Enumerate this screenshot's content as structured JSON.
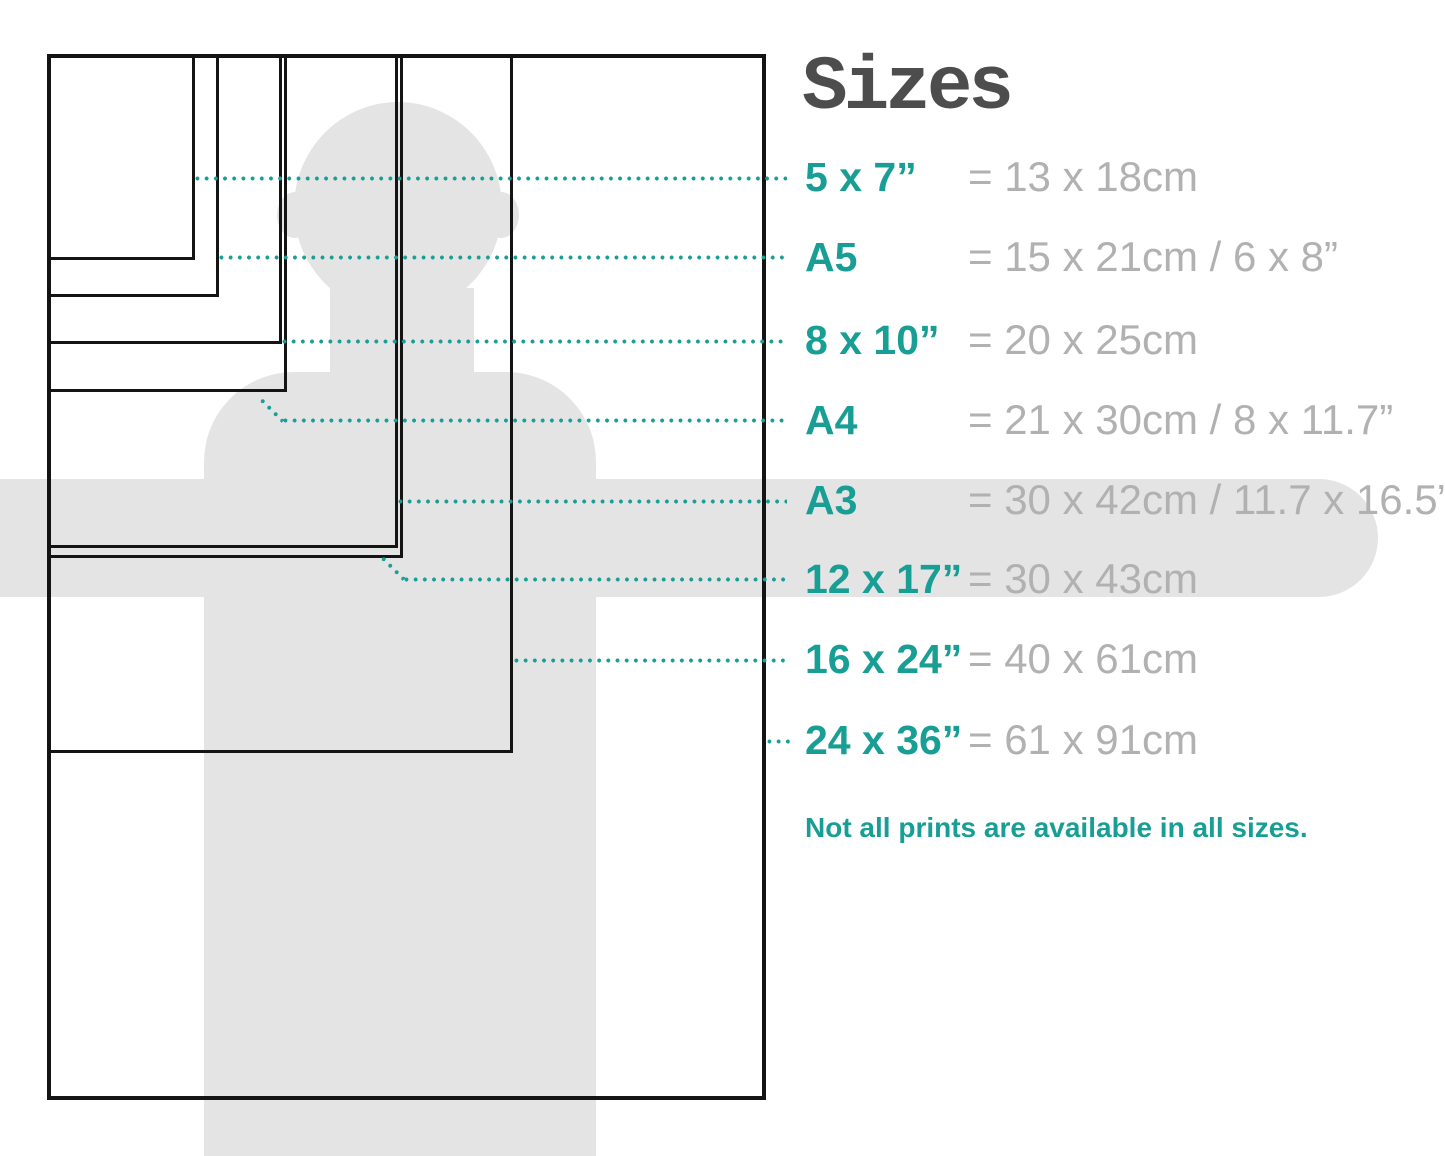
{
  "title": "Sizes",
  "note": "Not all prints are available in all sizes.",
  "colors": {
    "accent_teal": "#189e95",
    "value_grey": "#b1b1b1",
    "title_grey": "#4d4d4d",
    "silhouette_grey": "#e4e4e4",
    "box_border": "#141414"
  },
  "sizes": [
    {
      "label": "5 x 7”",
      "value": "= 13 x 18cm"
    },
    {
      "label": "A5",
      "value": "= 15 x 21cm / 6 x 8”"
    },
    {
      "label": "8 x 10”",
      "value": "= 20 x 25cm"
    },
    {
      "label": "A4",
      "value": "= 21 x 30cm / 8 x 11.7”"
    },
    {
      "label": "A3",
      "value": "= 30 x 42cm / 11.7 x 16.5”"
    },
    {
      "label": "12 x 17”",
      "value": "= 30 x 43cm"
    },
    {
      "label": "16 x 24”",
      "value": "= 40 x 61cm"
    },
    {
      "label": "24 x 36”",
      "value": "= 61 x 91cm"
    }
  ]
}
